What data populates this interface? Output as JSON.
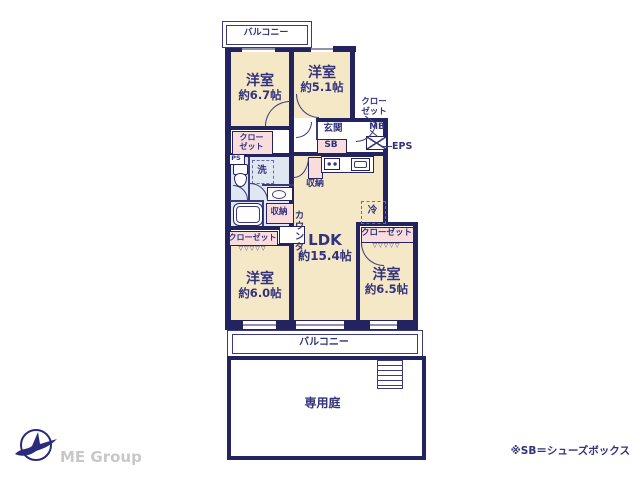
{
  "colors": {
    "wall": "#23235f",
    "room_fill": "#f5e8c6",
    "closet_fill": "#f9dcdc",
    "wet_area_fill": "#dfe7f1",
    "text": "#32327d",
    "logo_text": "#c8c8c8"
  },
  "plan": {
    "balcony_top": {
      "label": "バルコニー"
    },
    "balcony_bottom": {
      "label": "バルコニー"
    },
    "garden": {
      "label": "専用庭"
    },
    "rooms": {
      "west_67": {
        "name": "洋室",
        "size": "約6.7帖"
      },
      "west_51": {
        "name": "洋室",
        "size": "約5.1帖"
      },
      "west_60": {
        "name": "洋室",
        "size": "約6.0帖"
      },
      "west_65": {
        "name": "洋室",
        "size": "約6.5帖"
      },
      "ldk": {
        "name": "LDK",
        "size": "約15.4帖"
      }
    },
    "labels": {
      "genkan": "玄関",
      "shoe_box": "SB",
      "meter_box": "MB",
      "eps": "EPS",
      "pipe_space": "PS",
      "washer": "洗",
      "storage": "収納",
      "counter": "カウンター",
      "fridge": "冷",
      "closet": "クローゼット",
      "closet_line1": "クロー",
      "closet_line2": "ゼット",
      "zigzag": "▽▽▽▽▽"
    }
  },
  "footer": {
    "logo": "ME Group",
    "note": "※SB＝シューズボックス"
  }
}
